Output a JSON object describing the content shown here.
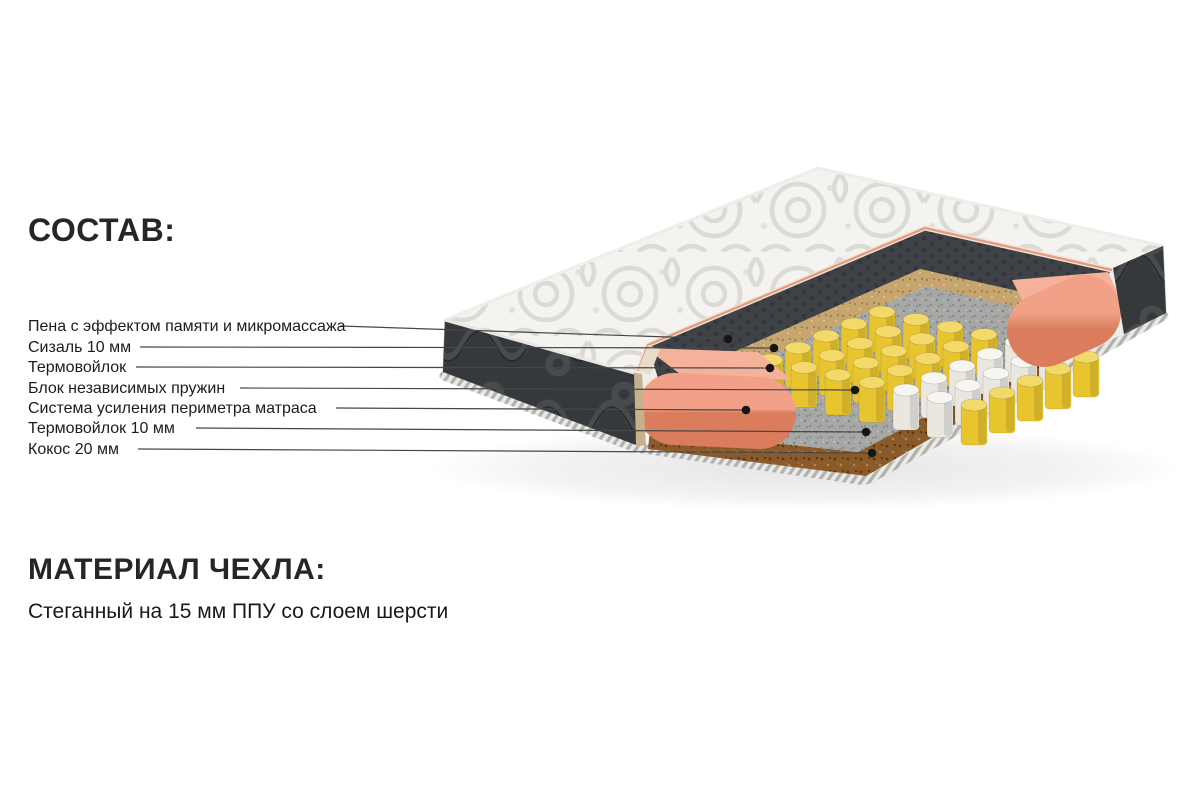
{
  "page": {
    "background": "#ffffff",
    "text_color": "#1f1f1f"
  },
  "composition": {
    "title": "СОСТАВ:",
    "items": [
      {
        "label": "Пена с эффектом памяти и микромассажа"
      },
      {
        "label": "Сизаль 10 мм"
      },
      {
        "label": "Термовойлок"
      },
      {
        "label": "Блок независимых пружин"
      },
      {
        "label": "Система усиления периметра матраса"
      },
      {
        "label": "Термовойлок 10 мм"
      },
      {
        "label": "Кокос 20 мм"
      }
    ]
  },
  "cover_material": {
    "title": "МАТЕРИАЛ ЧЕХЛА:",
    "description": "Стеганный на 15 мм ППУ со слоем шерсти"
  },
  "diagram": {
    "type": "mattress-cutaway",
    "layers": {
      "quilted_top": {
        "color": "#f4f3f0"
      },
      "side_fabric": {
        "color": "#36393c"
      },
      "memory_foam": {
        "color": "#3f4347"
      },
      "sisal": {
        "color": "#c6a66e"
      },
      "felt": {
        "color": "#a6a8a5"
      },
      "springs_yellow": {
        "color": "#e8c52f",
        "top": "#f3d969"
      },
      "springs_white": {
        "color": "#e9e7e0",
        "top": "#f6f5f0"
      },
      "perimeter_foam": {
        "color": "#ec9274"
      },
      "coconut": {
        "color": "#8a5a2b"
      },
      "piping": {
        "color": "#e59a7e"
      },
      "leader_line": {
        "color": "#474747"
      },
      "dot": {
        "color": "#151515"
      }
    }
  }
}
